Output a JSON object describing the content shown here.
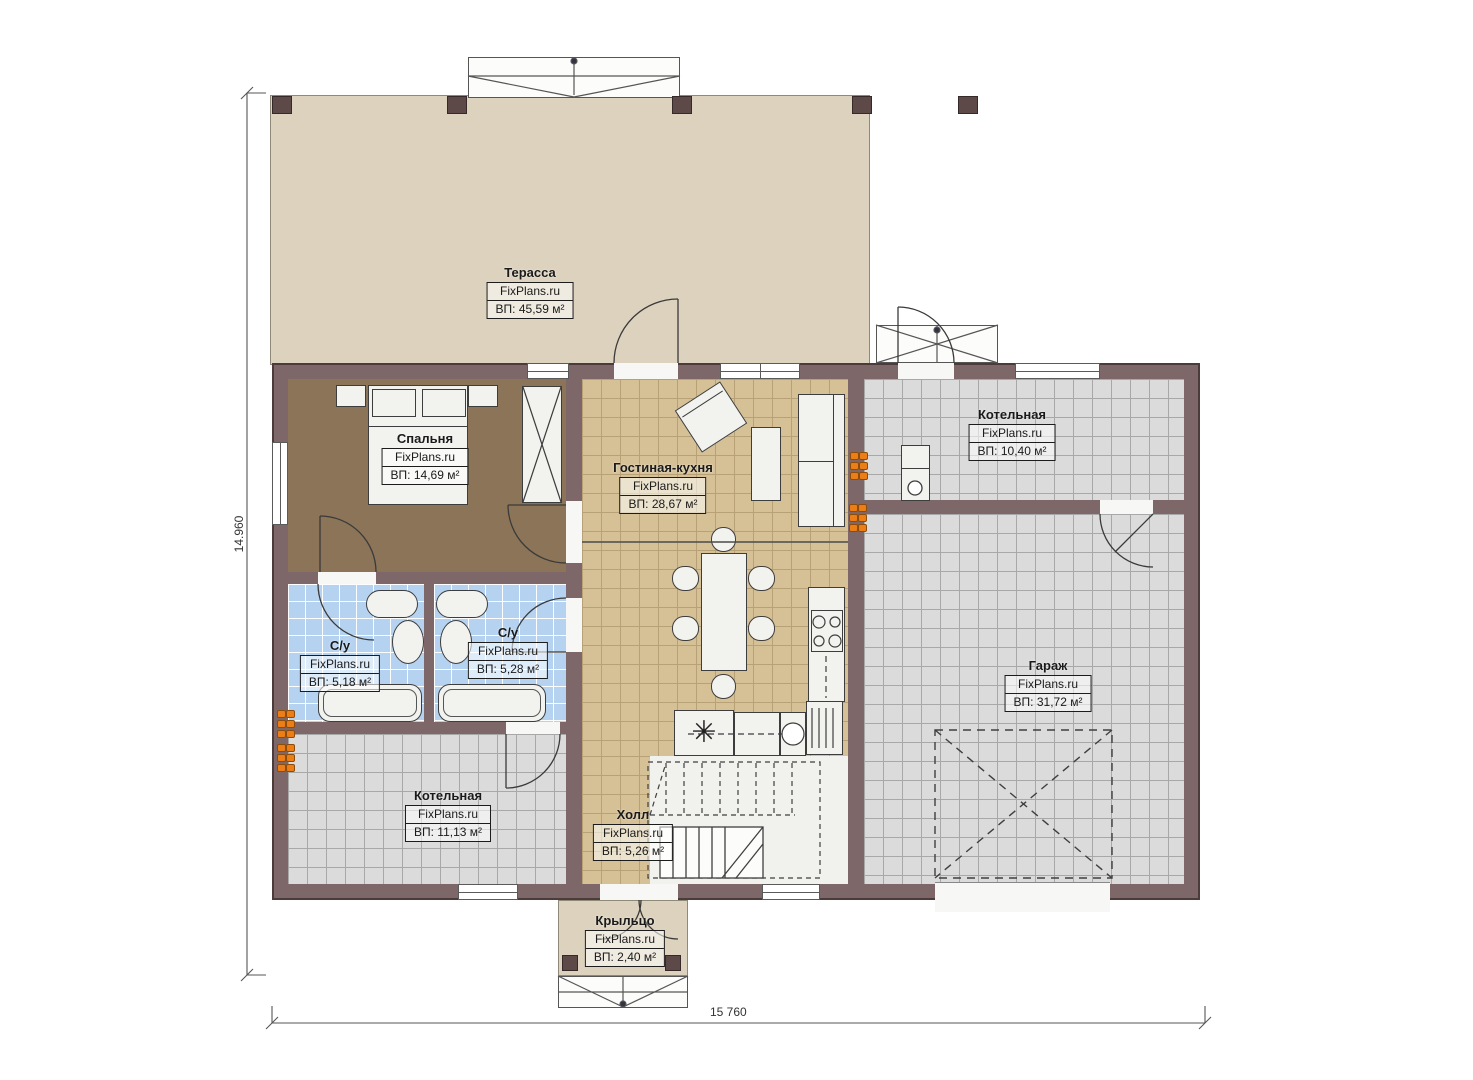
{
  "dimensions": {
    "left": "14.960",
    "bottom": "15 760"
  },
  "rooms": {
    "terrace": {
      "name": "Терасса",
      "brand": "FixPlans.ru",
      "area": "ВП: 45,59 м²"
    },
    "bedroom": {
      "name": "Спальня",
      "brand": "FixPlans.ru",
      "area": "ВП: 14,69 м²"
    },
    "living_kitchen": {
      "name": "Гостиная-кухня",
      "brand": "FixPlans.ru",
      "area": "ВП: 28,67 м²"
    },
    "boiler_top": {
      "name": "Котельная",
      "brand": "FixPlans.ru",
      "area": "ВП: 10,40 м²"
    },
    "garage": {
      "name": "Гараж",
      "brand": "FixPlans.ru",
      "area": "ВП: 31,72 м²"
    },
    "bathroom_left": {
      "name": "С/у",
      "brand": "FixPlans.ru",
      "area": "ВП: 5,18 м²"
    },
    "bathroom_right": {
      "name": "С/у",
      "brand": "FixPlans.ru",
      "area": "ВП: 5,28 м²"
    },
    "boiler_bottom": {
      "name": "Котельная",
      "brand": "FixPlans.ru",
      "area": "ВП: 11,13 м²"
    },
    "hall": {
      "name": "Холл",
      "brand": "FixPlans.ru",
      "area": "ВП: 5,26 м²"
    },
    "porch": {
      "name": "Крыльцо",
      "brand": "FixPlans.ru",
      "area": "ВП: 2,40 м²"
    }
  },
  "symbols": {
    "cooktop": "✳"
  },
  "colors": {
    "wall": "#7d6768",
    "terrace_floor": "#ddd2bd",
    "bedroom_floor": "#8b7458",
    "kitchen_floor": "#d6c096",
    "tile_gray": "#dbdbdb",
    "tile_blue": "#b5d3f1",
    "vent_orange": "#ec7e18"
  }
}
